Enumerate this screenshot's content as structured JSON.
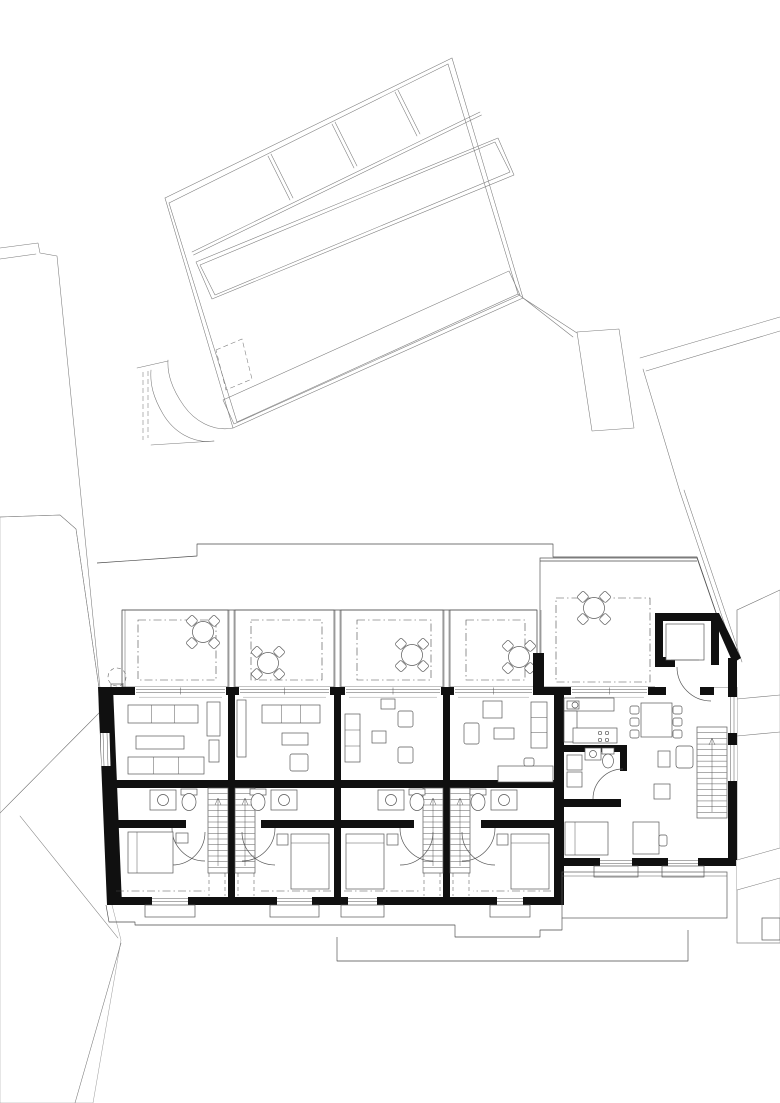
{
  "meta": {
    "type": "architectural-floor-plan",
    "storey": "attic-level with roof terraces",
    "canvas": [
      780,
      1103
    ],
    "visible_text": [],
    "colors": {
      "bg": "#ffffff",
      "wall": "#101010",
      "site_line": "#7a7a7a",
      "main_line": "#4a4a4a",
      "furniture_line": "#585858",
      "hatch": "#bdbdbd",
      "hatch_dark": "#9a9a9a"
    }
  },
  "site": {
    "paths": [
      "M165,198 L452,58",
      "M169,203 L448,64",
      "M452,58 L523,298",
      "M448,64 L518,294",
      "M523,298 L233,428",
      "M518,294 L237,422",
      "M233,428 L165,198",
      "M237,422 L169,203",
      "M192,252 L480,112",
      "M193.5,255 L481.5,115",
      "M268,156 L290,200",
      "M271,154 L293,198",
      "M332,124 L354,168",
      "M335,122 L357,166",
      "M395,92 L417,136",
      "M398,90 L420,134",
      "M196,262 L498,138 L514,175 L212,299 Z",
      "M200,265 L495,142 L510,172 L215,295 Z",
      "M577,332 L619,329 L634,428 L592,431 Z",
      "M523,298 L577,333",
      "M518,294 L573,337",
      "M0,248 L38,243 L40,253 L57,256 L100,688",
      "M0,259 L36,254",
      "M780,317 L640,358",
      "M780,331 L646,371",
      "M643,369 L680,492 L738,664",
      "M684,490 L742,662",
      "M233,428 C212,432 194,420 184,406 C174,392 167,376 168,360",
      "M214,441 C192,444 173,431 163,414 C153,397 150,384 151,370",
      "M151,445 L214,441",
      "M137,368 L168,361"
    ],
    "dashed_paths": [
      "M216,350 L242,339 L252,379 L226,390 Z",
      "M143,372 L143,440",
      "M148,371 L148,438"
    ],
    "walkway": "223,400 509,271 520,295 234,424"
  },
  "roof_left": {
    "hatch_h": "0,517 60,515 76,529 99,688 99,713 0,813",
    "hatch_v": "0,813 99,713 112,905 121,940 93,1103 0,1103",
    "lines": [
      "M0,517 L60,515 L76,529 L99,688 L112,905",
      "M0,813 L99,713",
      "M20,816 L118,938",
      "M121,943 L75,1103"
    ]
  },
  "roof_right": {
    "poly": "737,610 780,590 780,943 737,943",
    "lines": [
      "M737,610 L780,590",
      "M737,610 L737,943",
      "M737,943 L780,943",
      "M737,699 L780,695",
      "M737,736 L780,732"
    ],
    "white_band": "737,860 780,848 780,878 737,890",
    "band_edges": [
      "M737,860 L780,848",
      "M737,890 L780,878"
    ],
    "box": [
      762,
      918,
      18,
      22
    ]
  },
  "outlines": {
    "roof_edge": [
      "M97,563 L197,556 L197,544 L553,544 L553,557 L697,557 L733,662",
      "M540,561 L697,561",
      "M122,610 L537,610"
    ],
    "ground": [
      "M106,905 L109,922 L135,922 L135,925 L455,925 L455,937 L540,937 L540,930 L562,930 L562,918",
      "M337,937 L337,961 L688,961 L688,930"
    ],
    "tree": {
      "c": [
        117,
        677,
        9
      ],
      "box": [
        111,
        684,
        12,
        6
      ]
    }
  },
  "walls": {
    "left": "98,687 113,687 122,905 107,905",
    "party": [
      [
        228,
        687,
        7,
        218
      ],
      [
        334,
        687,
        7,
        218
      ],
      [
        443,
        687,
        7,
        218
      ]
    ],
    "big_west": [
      554,
      687,
      10,
      218
    ],
    "terrace_stub": [
      533,
      653,
      11,
      34
    ],
    "front_band": [
      [
        100,
        687,
        454,
        8
      ],
      [
        554,
        687,
        160,
        8
      ]
    ]
  },
  "openings": {
    "row": [
      [
        135,
        226
      ],
      [
        239,
        330
      ],
      [
        345,
        441
      ],
      [
        454,
        533
      ]
    ],
    "big_window": [
      571,
      648
    ],
    "big_door": [
      666,
      700
    ]
  },
  "terrace_dividers": [
    [
      122,
      125
    ],
    [
      229,
      234
    ],
    [
      335,
      340
    ],
    [
      444,
      449
    ],
    [
      537,
      541
    ]
  ],
  "bands": {
    "terrace": [
      610,
      687
    ],
    "stair": [
      788,
      873
    ]
  },
  "units": [
    {
      "id": 1,
      "x": [
        113,
        228
      ],
      "mirror": false,
      "terrace": [
        122,
        228
      ],
      "table": [
        203,
        632
      ],
      "niche": [
        152,
        188
      ],
      "variant": "A",
      "bed": "h",
      "left_window": true
    },
    {
      "id": 2,
      "x": [
        235,
        334
      ],
      "mirror": true,
      "terrace": [
        235,
        334
      ],
      "table": [
        268,
        663
      ],
      "niche": [
        277,
        312
      ],
      "variant": "B",
      "bed": "v",
      "left_window": false
    },
    {
      "id": 3,
      "x": [
        341,
        443
      ],
      "mirror": false,
      "terrace": [
        341,
        443
      ],
      "table": [
        412,
        655
      ],
      "niche": [
        348,
        377
      ],
      "variant": "C",
      "bed": "v",
      "left_window": false
    },
    {
      "id": 4,
      "x": [
        450,
        554
      ],
      "mirror": true,
      "terrace": [
        450,
        537
      ],
      "table": [
        519,
        657
      ],
      "niche": [
        497,
        523
      ],
      "variant": "D",
      "bed": "v",
      "left_window": false
    }
  ],
  "variants": {
    "A": [
      [
        "sofa",
        "L",
        15,
        705,
        70,
        18
      ],
      [
        "table",
        "L",
        23,
        736,
        48,
        13
      ],
      [
        "sofa",
        "L",
        15,
        757,
        76,
        17
      ],
      [
        "cab",
        "R",
        8,
        702,
        13,
        34
      ],
      [
        "cab",
        "R",
        9,
        740,
        10,
        22
      ]
    ],
    "B": [
      [
        "sofa",
        "L",
        14,
        705,
        58,
        18
      ],
      [
        "cab",
        "R",
        2,
        700,
        9,
        57
      ],
      [
        "table",
        "L",
        26,
        733,
        26,
        12
      ],
      [
        "chair",
        "L",
        26,
        754,
        18,
        17
      ]
    ],
    "C": [
      [
        "sofav",
        "L",
        4,
        714,
        15,
        48
      ],
      [
        "chair",
        "L",
        57,
        711,
        15,
        16
      ],
      [
        "chair",
        "L",
        57,
        747,
        15,
        16
      ],
      [
        "table",
        "L",
        31,
        731,
        14,
        12
      ],
      [
        "cab",
        "L",
        40,
        699,
        14,
        10
      ]
    ],
    "D": [
      [
        "cab",
        "R",
        33,
        701,
        19,
        17
      ],
      [
        "chair",
        "R",
        14,
        723,
        15,
        21
      ],
      [
        "table",
        "L",
        40,
        728,
        20,
        11
      ],
      [
        "sofav",
        "L",
        7,
        702,
        16,
        46
      ],
      [
        "desk",
        "L",
        1,
        766,
        55,
        16
      ],
      [
        "chair",
        "L",
        20,
        758,
        10,
        8
      ]
    ]
  },
  "big_terrace": {
    "poly": "540,558 697,558 733,662 733,687 540,687",
    "cover": "655,613 719,613 741,661 741,687 655,687",
    "dashdot": [
      556,
      598,
      94,
      84
    ],
    "table": [
      594,
      608
    ]
  },
  "big_unit": [
    [
      "w_r",
      655,
      613,
      64,
      8
    ],
    [
      "w_r",
      655,
      613,
      8,
      54
    ],
    [
      "w_r",
      711,
      621,
      8,
      44
    ],
    [
      "w_r",
      655,
      657,
      20,
      10
    ],
    [
      "w_pl",
      "711,613 719,613 741,658 733,663"
    ],
    [
      "w_r",
      728,
      658,
      9,
      202
    ],
    [
      "w_r",
      560,
      858,
      176,
      8
    ],
    [
      "w_r",
      564,
      745,
      63,
      7
    ],
    [
      "w_r",
      620,
      745,
      7,
      26
    ],
    [
      "w_r",
      564,
      799,
      57,
      8
    ],
    [
      "f_r",
      666,
      624,
      38,
      36
    ],
    [
      "ln",
      671,
      660,
      699,
      660
    ],
    [
      "arc",
      "M677,667 A34 34 0 0 0 711,701"
    ],
    [
      "win_v",
      728,
      697,
      9,
      36
    ],
    [
      "win_v",
      728,
      745,
      9,
      36
    ],
    [
      "win_h",
      600,
      858,
      32,
      8
    ],
    [
      "win_h",
      668,
      858,
      30,
      8
    ],
    [
      "sill",
      594,
      866,
      44,
      11
    ],
    [
      "sill",
      662,
      866,
      42,
      11
    ],
    [
      "fn_r",
      562,
      872,
      165,
      46
    ],
    [
      "ln",
      562,
      876,
      727,
      876
    ],
    [
      "f_r",
      564,
      698,
      50,
      13
    ],
    [
      "f_r",
      564,
      711,
      13,
      31
    ],
    [
      "f_r",
      573,
      728,
      44,
      15
    ],
    [
      "f_r",
      567,
      701,
      12,
      8
    ],
    [
      "c",
      575,
      705,
      3
    ],
    [
      "c",
      600,
      733,
      1.7
    ],
    [
      "c",
      607,
      733,
      1.7
    ],
    [
      "c",
      600,
      740,
      1.7
    ],
    [
      "c",
      607,
      740,
      1.7
    ],
    [
      "f_r",
      641,
      703,
      31,
      34
    ],
    [
      "ch",
      630,
      706
    ],
    [
      "ch",
      630,
      718
    ],
    [
      "ch",
      630,
      730
    ],
    [
      "ch",
      673,
      706
    ],
    [
      "ch",
      673,
      718
    ],
    [
      "ch",
      673,
      730
    ],
    [
      "f_r",
      567,
      755,
      15,
      15
    ],
    [
      "f_r",
      567,
      772,
      15,
      15
    ],
    [
      "f_r",
      585,
      748,
      16,
      12
    ],
    [
      "c",
      593,
      754,
      3.5
    ],
    [
      "f_r",
      602,
      748,
      12,
      6
    ],
    [
      "el",
      608,
      761,
      5.5,
      7
    ],
    [
      "arc",
      "M623,769 A30 30 0 0 0 593,799"
    ],
    [
      "fr_r",
      676,
      746,
      17,
      22,
      3
    ],
    [
      "f_r",
      658,
      751,
      12,
      16
    ],
    [
      "f_r",
      654,
      784,
      16,
      15
    ],
    [
      "stairs",
      697,
      727,
      30,
      91,
      16
    ],
    [
      "arrow",
      712,
      733,
      812
    ],
    [
      "f_r",
      565,
      822,
      43,
      33
    ],
    [
      "ln",
      575,
      822,
      575,
      855
    ],
    [
      "f_r",
      633,
      822,
      26,
      32
    ],
    [
      "fr_r",
      659,
      835,
      8,
      11,
      2
    ]
  ]
}
